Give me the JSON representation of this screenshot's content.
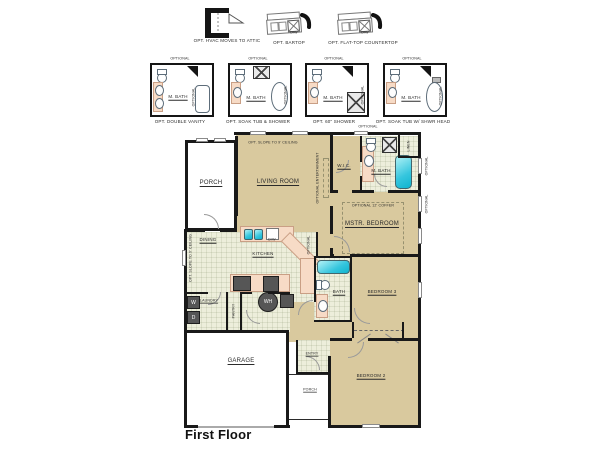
{
  "title": "First Floor",
  "options_row1": [
    {
      "label": "OPT. HVAC MOVES TO ATTIC"
    },
    {
      "label": "OPT. BARTOP",
      "sink_label": "D/W"
    },
    {
      "label": "OPT. FLAT-TOP COUNTERTOP",
      "sink_label": "D/W"
    }
  ],
  "options_row2": [
    {
      "label": "OPT. DOUBLE VANITY",
      "room": "M. BATH"
    },
    {
      "label": "OPT. SOAK TUB & SHOWER",
      "room": "M. BATH"
    },
    {
      "label": "OPT. 60\" SHOWER",
      "room": "M. BATH"
    },
    {
      "label": "OPT. SOAK TUB W/ SHWR HEAD",
      "room": "M. BATH"
    }
  ],
  "annotations": {
    "optional": "OPTIONAL",
    "slope_ceiling": "OPT. SLOPE TO 9' CEILING",
    "entertainment": "OPTIONAL ENTERTAINMENT",
    "coffer": "OPTIONAL 12' COFFER",
    "dw": "D/W",
    "washer": "W",
    "dryer": "D",
    "water_heater": "WH"
  },
  "rooms": {
    "porch_top": "PORCH",
    "living": "LIVING ROOM",
    "wic": "W.I.C.",
    "mbath": "M. BATH",
    "linen": "LINEN",
    "mbed": "MSTR. BEDROOM",
    "dining": "DINING",
    "kitchen": "KITCHEN",
    "laundry": "LAUNDRY",
    "pantry": "PANTRY",
    "bath": "BATH",
    "bed3": "BEDROOM 3",
    "bed2": "BEDROOM 2",
    "entry": "ENTRY",
    "porch_bottom": "PORCH",
    "garage": "GARAGE"
  },
  "colors": {
    "wall": "#191919",
    "carpet": "#d9c99e",
    "tile": "#edeedb",
    "counter": "#f7dbc6",
    "fixture": "#2ec8de",
    "appliance": "#565656"
  }
}
